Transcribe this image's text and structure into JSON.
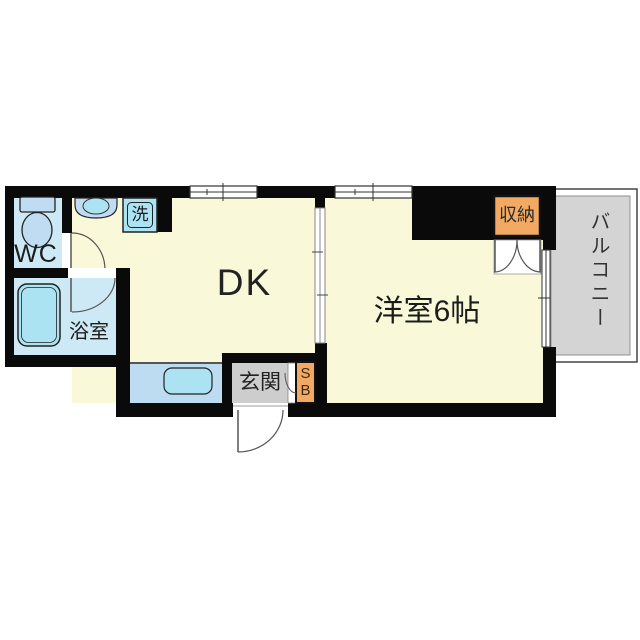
{
  "floorplan": {
    "title": "1DK apartment floor plan",
    "rooms": {
      "wc": {
        "label": "WC"
      },
      "bathroom": {
        "label": "浴室"
      },
      "washer": {
        "label": "洗"
      },
      "dk": {
        "label": "DK"
      },
      "western_room": {
        "label": "洋室6帖"
      },
      "closet": {
        "label": "収納"
      },
      "entrance": {
        "label": "玄関"
      },
      "shoe_box": {
        "label": "SB"
      },
      "balcony": {
        "label": "バルコニー"
      }
    },
    "fixtures": {
      "toilet": "toilet",
      "vanity": "wash-basin",
      "washing_machine_pan": "washing-machine",
      "bathtub": "bathtub",
      "kitchen_sink": "kitchen-sink"
    },
    "colors": {
      "floor": "#F9F8D9",
      "wet_room": "#CDE9F5",
      "fixture": "#ABE3F3",
      "fixture_alt": "#BFDCF2",
      "counter": "#BDDCF2",
      "storage": "#F1A964",
      "entrance_floor": "#CDCDCD",
      "balcony_floor": "#D4D4D4",
      "wall": "#0A0A0A"
    }
  }
}
